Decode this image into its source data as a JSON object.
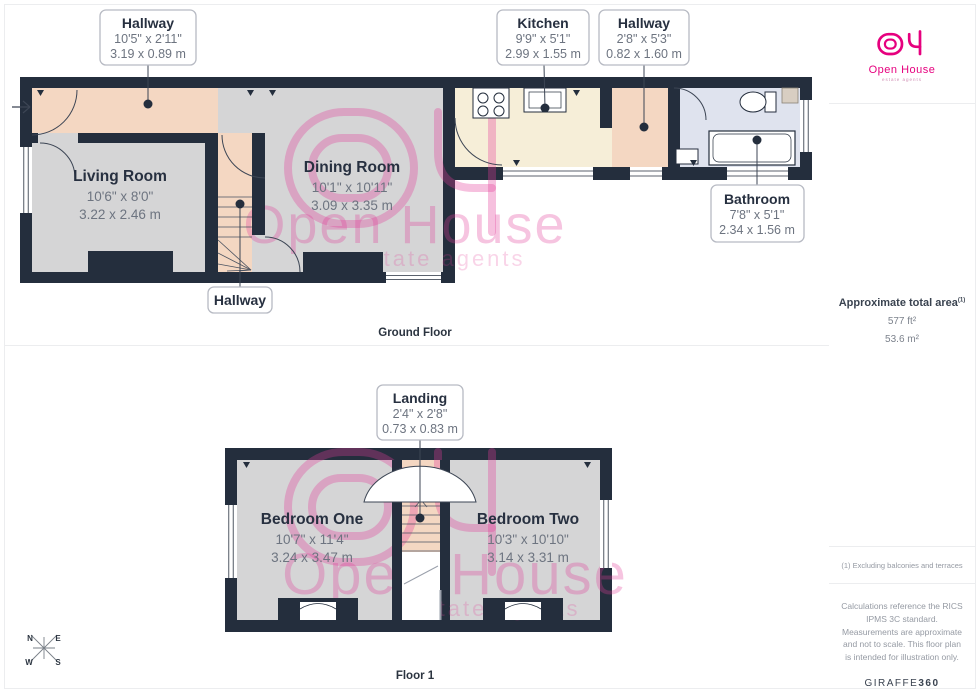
{
  "meta": {
    "brand": "Open House",
    "tagline": "estate agents"
  },
  "colors": {
    "wall": "#242e3d",
    "floor_gray": "#d5d5d6",
    "floor_peach": "#f4d7c2",
    "floor_cream": "#f6eed8",
    "floor_blue": "#dfe3ee",
    "brand_pink": "#e6007e"
  },
  "ground_floor": {
    "caption": "Ground Floor",
    "labels": {
      "hallway_top": {
        "title": "Hallway",
        "imperial": "10'5\" x 2'11\"",
        "metric": "3.19 x 0.89 m"
      },
      "kitchen": {
        "title": "Kitchen",
        "imperial": "9'9\" x 5'1\"",
        "metric": "2.99 x 1.55 m"
      },
      "hallway_right": {
        "title": "Hallway",
        "imperial": "2'8\" x 5'3\"",
        "metric": "0.82 x 1.60 m"
      },
      "bathroom": {
        "title": "Bathroom",
        "imperial": "7'8\" x 5'1\"",
        "metric": "2.34 x 1.56 m"
      },
      "hallway_stairs": {
        "title": "Hallway"
      }
    },
    "rooms": {
      "living_room": {
        "title": "Living Room",
        "imperial": "10'6\" x 8'0\"",
        "metric": "3.22 x 2.46 m"
      },
      "dining_room": {
        "title": "Dining Room",
        "imperial": "10'1\" x 10'11\"",
        "metric": "3.09 x 3.35 m"
      }
    }
  },
  "floor_1": {
    "caption": "Floor 1",
    "labels": {
      "landing": {
        "title": "Landing",
        "imperial": "2'4\" x 2'8\"",
        "metric": "0.73 x 0.83 m"
      }
    },
    "rooms": {
      "bedroom_one": {
        "title": "Bedroom One",
        "imperial": "10'7\" x 11'4\"",
        "metric": "3.24 x 3.47 m"
      },
      "bedroom_two": {
        "title": "Bedroom Two",
        "imperial": "10'3\" x 10'10\"",
        "metric": "3.14 x 3.31 m"
      }
    }
  },
  "sidebar": {
    "area_title": "Approximate total area",
    "area_superscript": "(1)",
    "area_ft": "577 ft²",
    "area_m": "53.6 m²",
    "note_1": "(1) Excluding balconies and terraces",
    "note_2": "Calculations reference the RICS IPMS 3C standard. Measurements are approximate and not to scale. This floor plan is intended for illustration only.",
    "brand_name": "GIRAFFE",
    "brand_suffix": "360"
  },
  "compass": {
    "n": "N",
    "e": "E",
    "s": "S",
    "w": "W"
  }
}
